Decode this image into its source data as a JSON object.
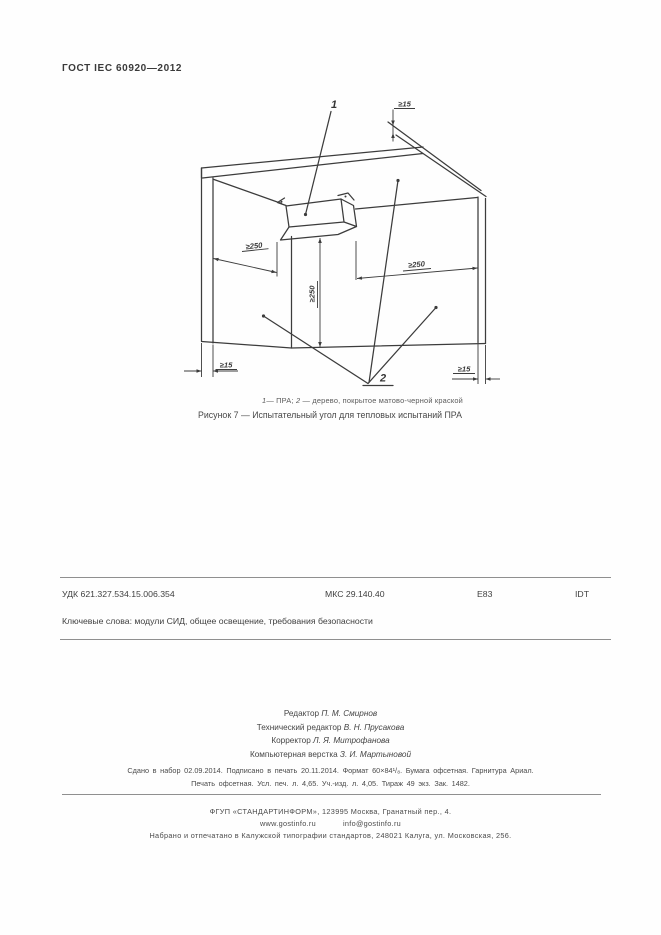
{
  "page": {
    "header": "ГОСТ IEC 60920—2012"
  },
  "figure": {
    "labels": {
      "part1": "1",
      "part2": "2",
      "dim250": "≥250",
      "dim15": "≥15"
    },
    "caption": {
      "num1": "1",
      "text1": "— ПРА; ",
      "num2": "2",
      "text2": " — дерево, покрытое матово-черной краской"
    },
    "title": "Рисунок 7 — Испытательный угол для тепловых испытаний ПРА"
  },
  "index_row": {
    "udk": "УДК 621.327.534.15.006.354",
    "mks": "МКС 29.140.40",
    "e": "Е83",
    "idt": "IDT"
  },
  "keywords": "Ключевые слова: модули СИД, общее освещение,  требования безопасности",
  "credits": [
    {
      "role": "Редактор ",
      "name": "П. М. Смирнов"
    },
    {
      "role": "Технический редактор ",
      "name": "В. Н. Прусакова"
    },
    {
      "role": "Корректор ",
      "name": "Л. Я. Митрофанова"
    },
    {
      "role": "Компьютерная верстка ",
      "name": "З. И. Мартыновой"
    }
  ],
  "colophon": {
    "line1": "Сдано в набор 02.09.2014.  Подписано в печать 20.11.2014.  Формат 60×84¹/₈.  Бумага офсетная.  Гарнитура Ариал.",
    "line2": "Печать офсетная.  Усл. печ. л. 4,65.  Уч.-изд. л. 4,05.  Тираж 49 экз.  Зак. 1482."
  },
  "publisher": {
    "line1": "ФГУП «СТАНДАРТИНФОРМ», 123995 Москва, Гранатный пер., 4.",
    "site": "www.gostinfo.ru",
    "email": "info@gostinfo.ru",
    "line3": "Набрано и отпечатано в Калужской типографии стандартов, 248021 Калуга, ул. Московская, 256."
  }
}
